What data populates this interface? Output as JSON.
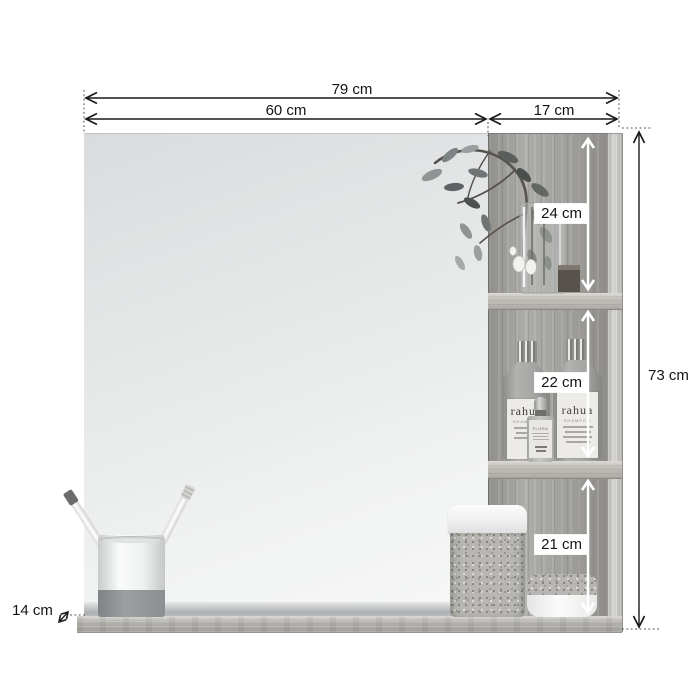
{
  "diagram": {
    "dimensions": {
      "total_width": "79 cm",
      "mirror_width": "60 cm",
      "side_shelf_width": "17 cm",
      "total_height": "73 cm",
      "top_compartment_height": "24 cm",
      "middle_compartment_height": "22 cm",
      "bottom_compartment_height": "21 cm",
      "shelf_depth": "14 cm"
    },
    "decor": {
      "shampoo_brand": "rahua",
      "shampoo_sub": "SHAMPOO",
      "serum_label": "FLORA"
    },
    "colors": {
      "background": "#ffffff",
      "dimension_line": "#1a1a1a",
      "inner_arrow": "#ffffff",
      "wood_mid": "#a7a6a2",
      "wood_light": "#c9c8c4",
      "mirror_top": "#d9dbdd",
      "mirror_bottom": "#f6f7f6"
    }
  }
}
